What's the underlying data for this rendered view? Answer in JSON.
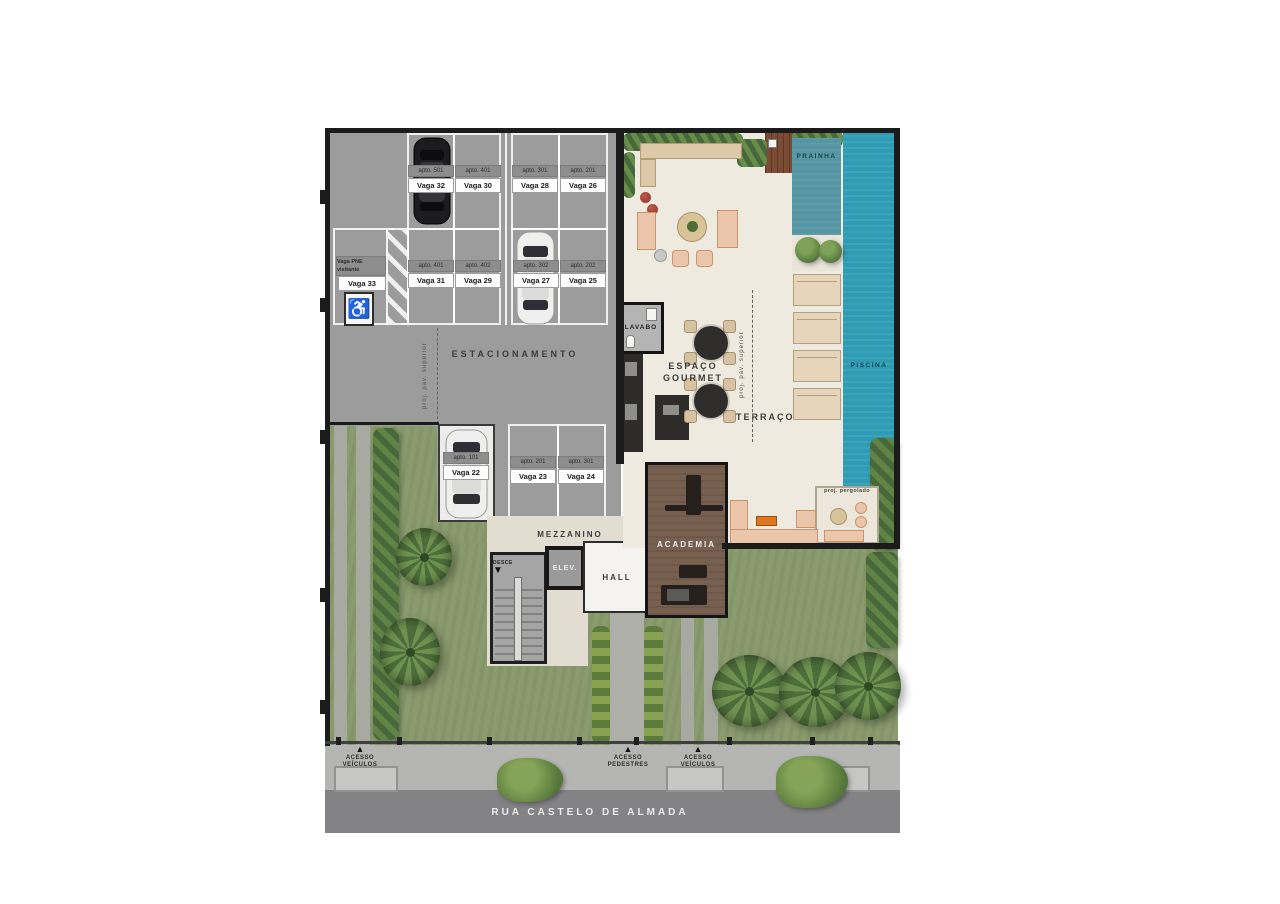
{
  "site": {
    "street_name": "RUA CASTELO DE ALMADA",
    "access_points": [
      {
        "label": "ACESSO VEÍCULOS"
      },
      {
        "label": "ACESSO PEDESTRES"
      },
      {
        "label": "ACESSO VEÍCULOS"
      }
    ],
    "arrow_up_icon": "▲"
  },
  "parking": {
    "area_label": "ESTACIONAMENTO",
    "note_projection": "proj. pav. superior",
    "stalls": [
      {
        "apto": "apto. 501",
        "vaga": "Vaga 32"
      },
      {
        "apto": "apto. 401",
        "vaga": "Vaga 30"
      },
      {
        "apto": "apto. 301",
        "vaga": "Vaga 28"
      },
      {
        "apto": "apto. 201",
        "vaga": "Vaga 26"
      },
      {
        "apto": "apto. 401",
        "vaga": "Vaga 31"
      },
      {
        "apto": "apto. 402",
        "vaga": "Vaga 29"
      },
      {
        "apto": "apto. 302",
        "vaga": "Vaga 27"
      },
      {
        "apto": "apto. 202",
        "vaga": "Vaga 25"
      },
      {
        "apto": "apto. 101",
        "vaga": "Vaga 22"
      },
      {
        "apto": "apto. 201",
        "vaga": "Vaga 23"
      },
      {
        "apto": "apto. 301",
        "vaga": "Vaga 24"
      }
    ],
    "pne_stall": {
      "tag": "Vaga PNE visitante",
      "vaga": "Vaga 33",
      "wheelchair_icon": "♿"
    }
  },
  "amenities": {
    "mezzanino": "MEZZANINO",
    "elevator": "ELEV.",
    "hall": "HALL",
    "academia": "ACADEMIA",
    "lavabo": "LAVABO",
    "espaco_gourmet": "ESPAÇO GOURMET",
    "terraco": "TERRAÇO",
    "prainha": "PRAINHA",
    "piscina": "PISCINA",
    "note_projection": "proj. pav. superior",
    "note_pergola": "proj. pergolado",
    "stairs_label": "DESCE",
    "stairs_arrow_icon": "▼"
  },
  "colors": {
    "garage_floor": "#9c9c9c",
    "terrace_floor": "#eeeae0",
    "pool": "#2e9cb4",
    "prainha": "#5595a4",
    "lawn": "#8a9b6d",
    "street": "#838385",
    "sidewalk": "#b5b5b3",
    "academia_floor": "#77604f",
    "deck_wood": "#7b4b33",
    "furniture": "#ecc6aa",
    "wall": "#1b1b1b"
  }
}
